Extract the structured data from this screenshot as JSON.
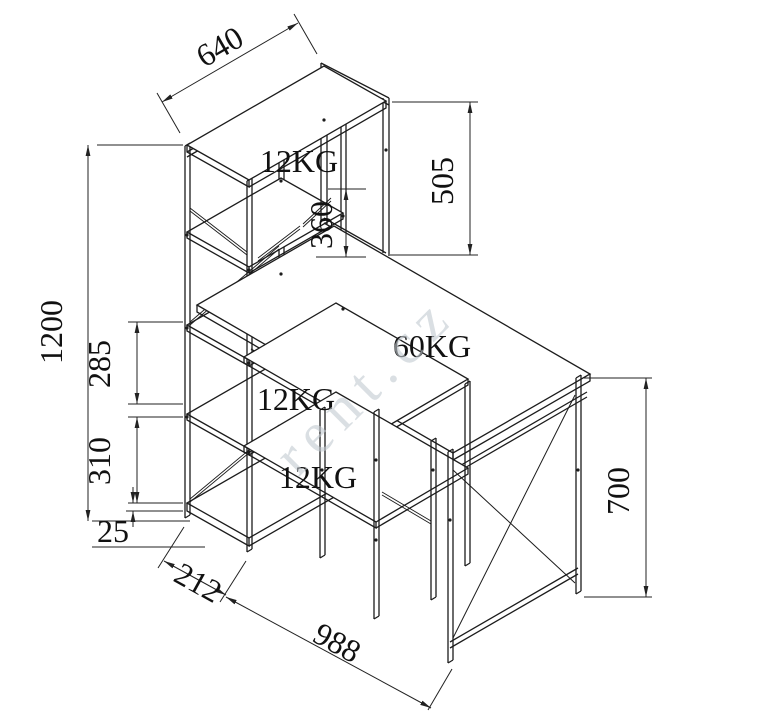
{
  "drawing": {
    "title": "desk-with-shelf-technical-drawing",
    "line_color": "#1c1c1c",
    "dim_color": "#222222",
    "watermark": {
      "text": "rent.cz",
      "color": "#c3cbd1"
    },
    "dimensions": {
      "top_shelf_width": "640",
      "hutch_frame_height": "505",
      "hutch_clearance": "360",
      "total_height": "1200",
      "upper_shelf_gap": "285",
      "lower_shelf_gap": "310",
      "base_rail_height": "25",
      "tower_depth": "212",
      "desk_length": "988",
      "desk_height": "700"
    },
    "load_labels": {
      "top_shelf": "12KG",
      "desktop": "60KG",
      "middle_shelf": "12KG",
      "bottom_shelf": "12KG"
    }
  }
}
